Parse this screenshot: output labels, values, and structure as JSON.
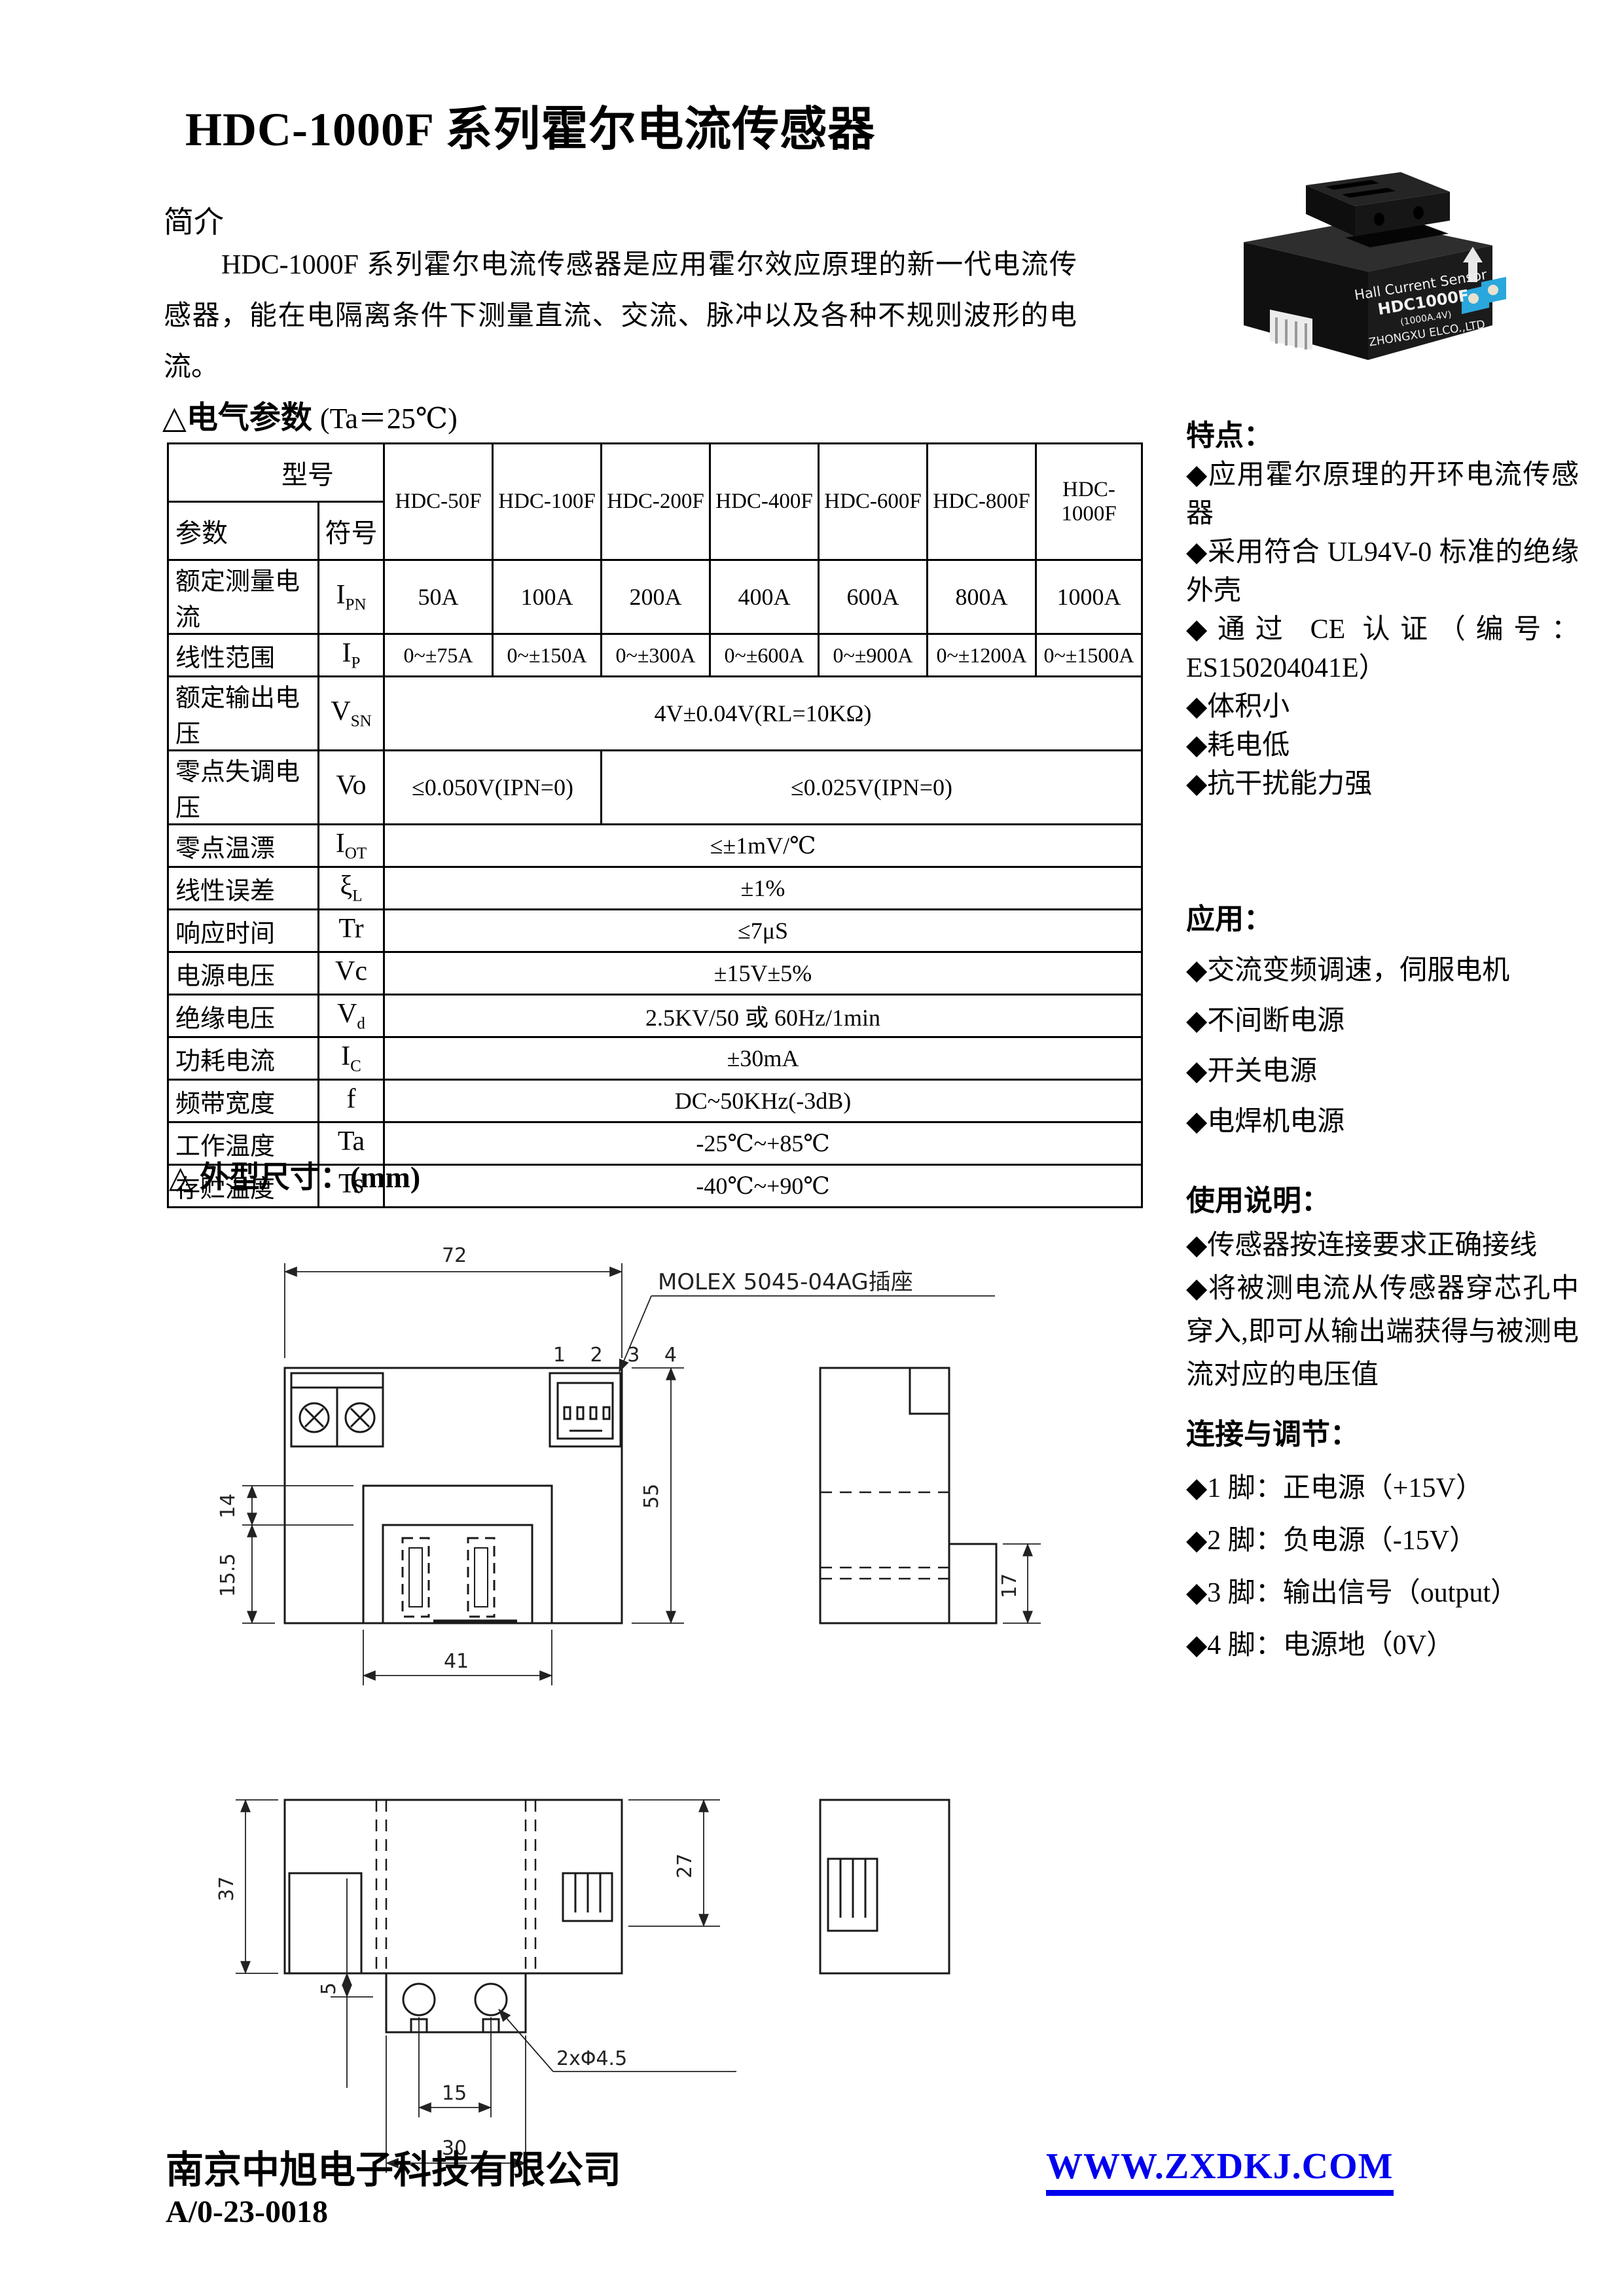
{
  "doc": {
    "title": "HDC-1000F 系列霍尔电流传感器",
    "intro_heading": "简介",
    "intro_text": "HDC-1000F 系列霍尔电流传感器是应用霍尔效应原理的新一代电流传感器，能在电隔离条件下测量直流、交流、脉冲以及各种不规则波形的电流。"
  },
  "photo": {
    "line1": "Hall Current Sensor",
    "line2": "HDC1000F",
    "line3": "(1000A.4V)",
    "line4": "ZHONGXU ELCO.,LTD"
  },
  "electrical": {
    "heading": "△电气参数",
    "condition": "(Ta＝25℃)"
  },
  "table": {
    "model_label": "型号",
    "param_label": "参数",
    "symbol_label": "符号",
    "models": [
      "HDC-50F",
      "HDC-100F",
      "HDC-200F",
      "HDC-400F",
      "HDC-600F",
      "HDC-800F",
      "HDC-1000F"
    ],
    "rows": {
      "ipn": {
        "label": "额定测量电流",
        "sym": "I",
        "sub": "PN",
        "values": [
          "50A",
          "100A",
          "200A",
          "400A",
          "600A",
          "800A",
          "1000A"
        ]
      },
      "ip": {
        "label": "线性范围",
        "sym": "I",
        "sub": "P",
        "values": [
          "0~±75A",
          "0~±150A",
          "0~±300A",
          "0~±600A",
          "0~±900A",
          "0~±1200A",
          "0~±1500A"
        ]
      },
      "vsn": {
        "label": "额定输出电压",
        "sym": "V",
        "sub": "SN",
        "value": "4V±0.04V(RL=10KΩ)"
      },
      "vo": {
        "label": "零点失调电压",
        "sym": "Vo",
        "sub": "",
        "value_a": "≤0.050V(IPN=0)",
        "value_b": "≤0.025V(IPN=0)"
      },
      "iot": {
        "label": "零点温漂",
        "sym": "I",
        "sub": "OT",
        "value": "≤±1mV/℃"
      },
      "xl": {
        "label": "线性误差",
        "sym": "ξ",
        "sub": "L",
        "value": "±1%"
      },
      "tr": {
        "label": "响应时间",
        "sym": "Tr",
        "sub": "",
        "value": "≤7μS"
      },
      "vc": {
        "label": "电源电压",
        "sym": "Vc",
        "sub": "",
        "value": "±15V±5%"
      },
      "vd": {
        "label": "绝缘电压",
        "sym": "V",
        "sub": "d",
        "value": "2.5KV/50 或 60Hz/1min"
      },
      "ic": {
        "label": "功耗电流",
        "sym": "I",
        "sub": "C",
        "value": "±30mA"
      },
      "f": {
        "label": "频带宽度",
        "sym": "f",
        "sub": "",
        "value": "DC~50KHz(-3dB)"
      },
      "ta": {
        "label": "工作温度",
        "sym": "Ta",
        "sub": "",
        "value": "-25℃~+85℃"
      },
      "ts": {
        "label": "存贮温度",
        "sym": "Ts",
        "sub": "",
        "value": "-40℃~+90℃"
      }
    }
  },
  "sidebar": {
    "features_title": "特点：",
    "features": [
      "◆应用霍尔原理的开环电流传感器",
      "◆采用符合 UL94V-0 标准的绝缘外壳",
      "◆通过 CE 认证（编号：ES150204041E）",
      "◆体积小",
      "◆耗电低",
      "◆抗干扰能力强"
    ],
    "applications_title": "应用：",
    "applications": [
      "◆交流变频调速，伺服电机",
      "◆不间断电源",
      "◆开关电源",
      "◆电焊机电源"
    ],
    "usage_title": "使用说明：",
    "usage": [
      "◆传感器按连接要求正确接线",
      "◆将被测电流从传感器穿芯孔中穿入,即可从输出端获得与被测电流对应的电压值"
    ],
    "connection_title": "连接与调节：",
    "connections": [
      "◆1 脚：正电源（+15V）",
      "◆2 脚：负电源（-15V）",
      "◆3 脚：输出信号（output）",
      "◆4 脚：电源地（0V）"
    ]
  },
  "dimensions": {
    "heading": "△ 外型尺寸：",
    "unit": "(mm)",
    "connector_label": "MOLEX 5045-04AG插座",
    "pins": "1 2 3 4",
    "front_width": "72",
    "front_height": "55",
    "dim_14": "14",
    "dim_15_5": "15.5",
    "dim_41": "41",
    "dim_17": "17",
    "dim_37": "37",
    "dim_27": "27",
    "dim_5": "5",
    "dim_15": "15",
    "dim_30": "30",
    "hole_callout": "2xΦ4.5"
  },
  "footer": {
    "company": "南京中旭电子科技有限公司",
    "doc_number": "A/0-23-0018",
    "website": "WWW.ZXDKJ.COM"
  },
  "colors": {
    "link_blue": "#0000EE",
    "text_black": "#000000"
  }
}
